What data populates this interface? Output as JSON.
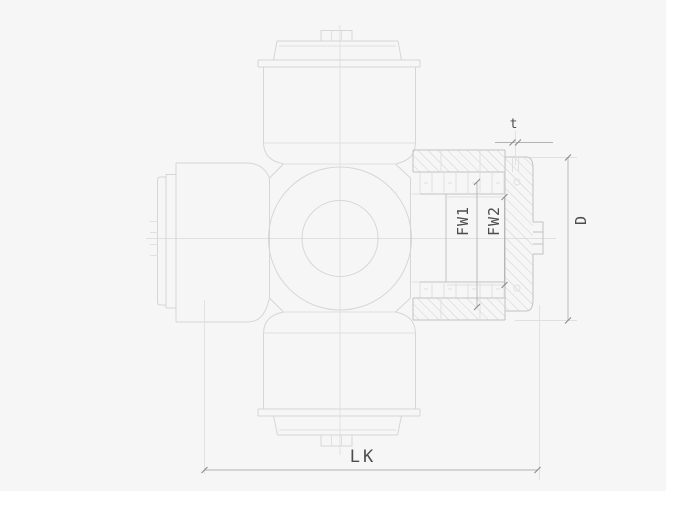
{
  "drawing": {
    "labels": {
      "thickness": "t",
      "bearing-width-1": "FW1",
      "bearing-width-2": "FW2",
      "outer-diameter": "D",
      "overall-length": "LK"
    },
    "colors": {
      "bg": "#f6f6f6",
      "paper": "#ffffff",
      "line": "#d6d6d6",
      "line-faint": "#e0e0e0",
      "line-strong": "#c2c2c2",
      "hatch": "#cccccc",
      "dim": "#b3b3b3",
      "tick": "#8f8f8f",
      "text": "#4d4d4d"
    }
  }
}
